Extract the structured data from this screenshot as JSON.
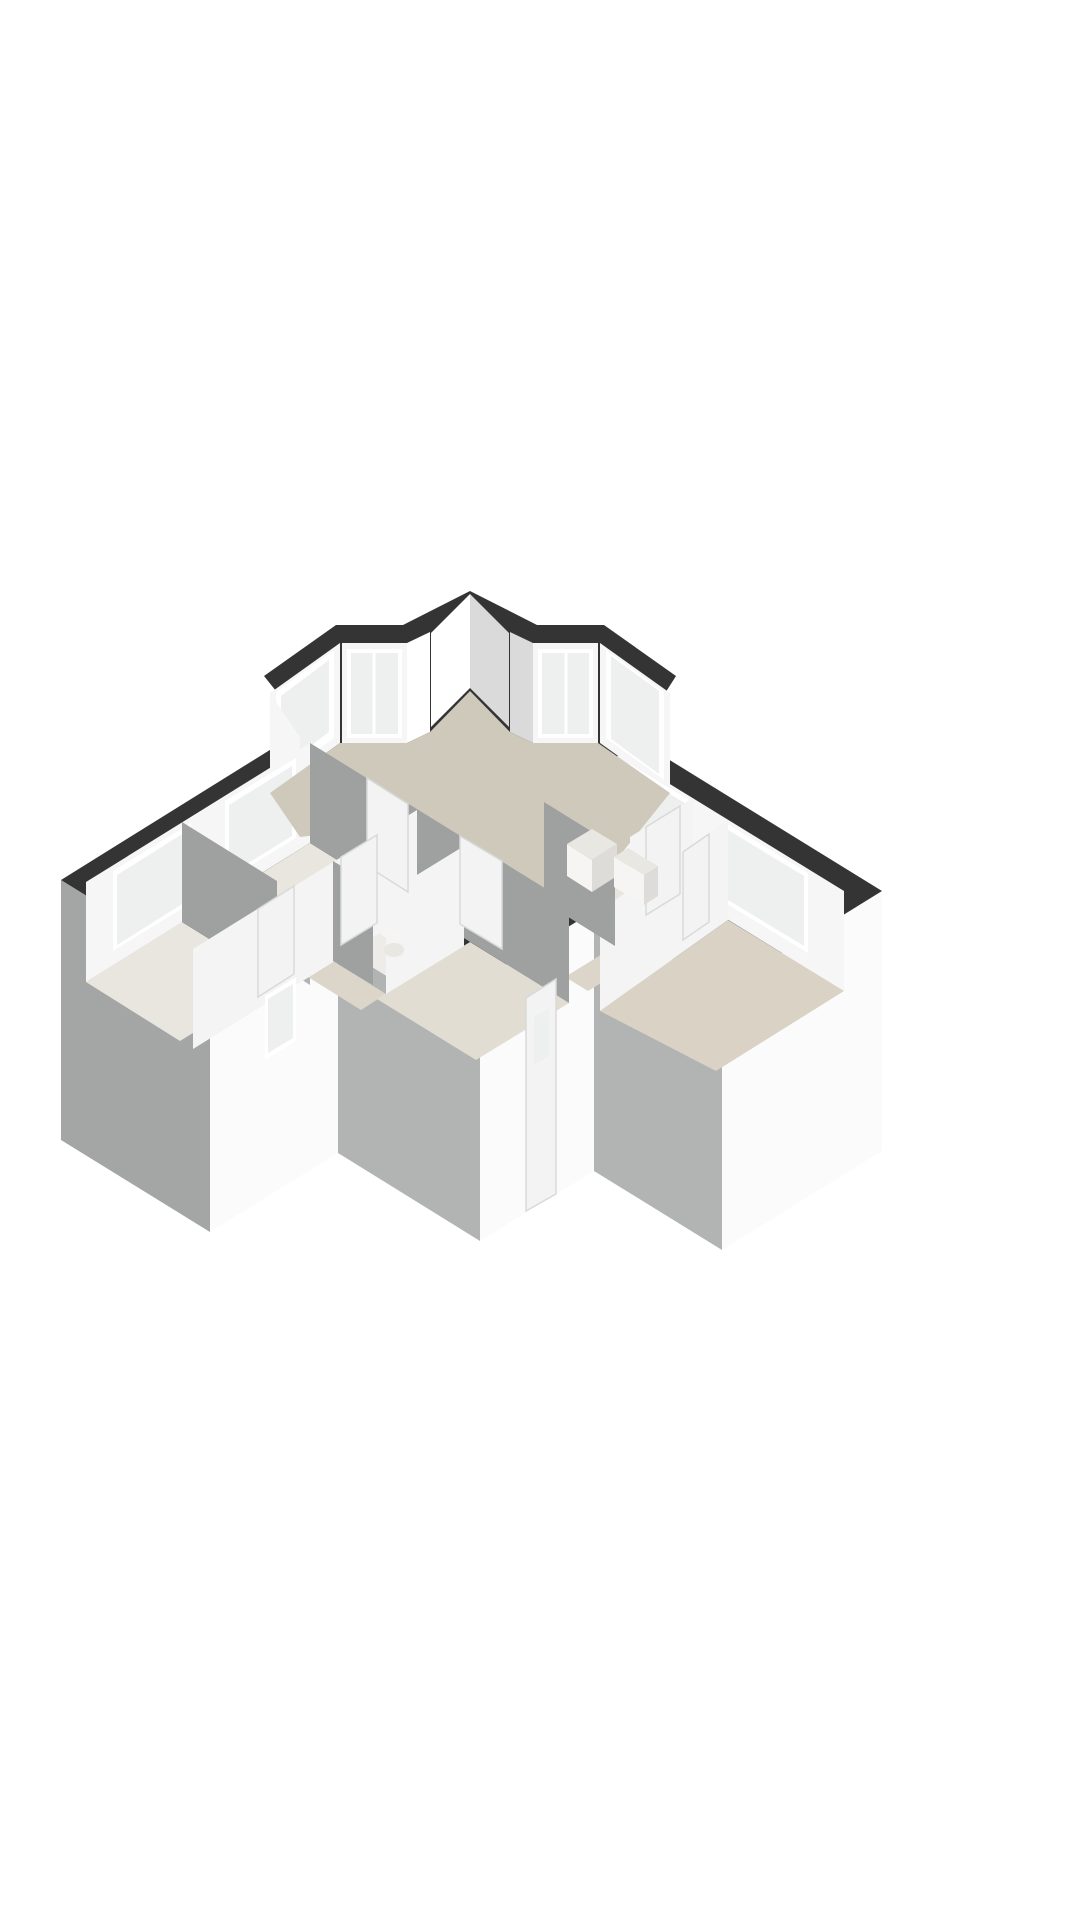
{
  "meta": {
    "content_type": "3d-floor-plan-render",
    "view": "isometric-cutaway-from-above",
    "has_text": false
  },
  "palette": {
    "page_bg": "#ffffff",
    "wall_top": "#343434",
    "face_white": "#fbfbfb",
    "face_white2": "#f2f2f2",
    "face_gray": "#b2b4b3",
    "face_gray2": "#a4a6a5",
    "inner_white": "#f6f6f6",
    "inner_bright": "#ffffff",
    "inner_shade": "#d9dad9",
    "interior_gray": "#9fa1a0",
    "interior_white": "#f4f4f4",
    "floor_living": "#cfc9bc",
    "floor_room": "#e9e6df",
    "floor_hall": "#dcd6ca",
    "floor_wc": "#edece8",
    "floor_corridor": "#e2ddd3",
    "floor_bed3": "#d9d2c5",
    "glass": "#edf0ee",
    "frame": "#ffffff",
    "sill": "#e3e3e3",
    "door": "#f3f3f3",
    "door_edge": "#d9d9d9",
    "fixture_top": "#e9e7e2",
    "fixture_face": "#f6f5f3",
    "fixture_side": "#dddcd9"
  },
  "rooms": [
    {
      "id": "living-room",
      "floor_color_key": "floor_living"
    },
    {
      "id": "bedroom-1",
      "floor_color_key": "floor_room"
    },
    {
      "id": "bedroom-2",
      "floor_color_key": "floor_room"
    },
    {
      "id": "bedroom-3",
      "floor_color_key": "floor_bed3"
    },
    {
      "id": "bathroom",
      "floor_color_key": "floor_room"
    },
    {
      "id": "wc",
      "floor_color_key": "floor_wc"
    },
    {
      "id": "hallway",
      "floor_color_key": "floor_hall"
    },
    {
      "id": "corridor",
      "floor_color_key": "floor_corridor"
    }
  ],
  "features": [
    "bay-window-left",
    "bay-window-right",
    "center-notch-wall",
    "front-door-with-small-window",
    "interior-doors",
    "kitchen-unit",
    "bathroom-sink-vanity",
    "wc-toilet",
    "exterior-windows-left-wing",
    "exterior-windows-right-wing"
  ]
}
